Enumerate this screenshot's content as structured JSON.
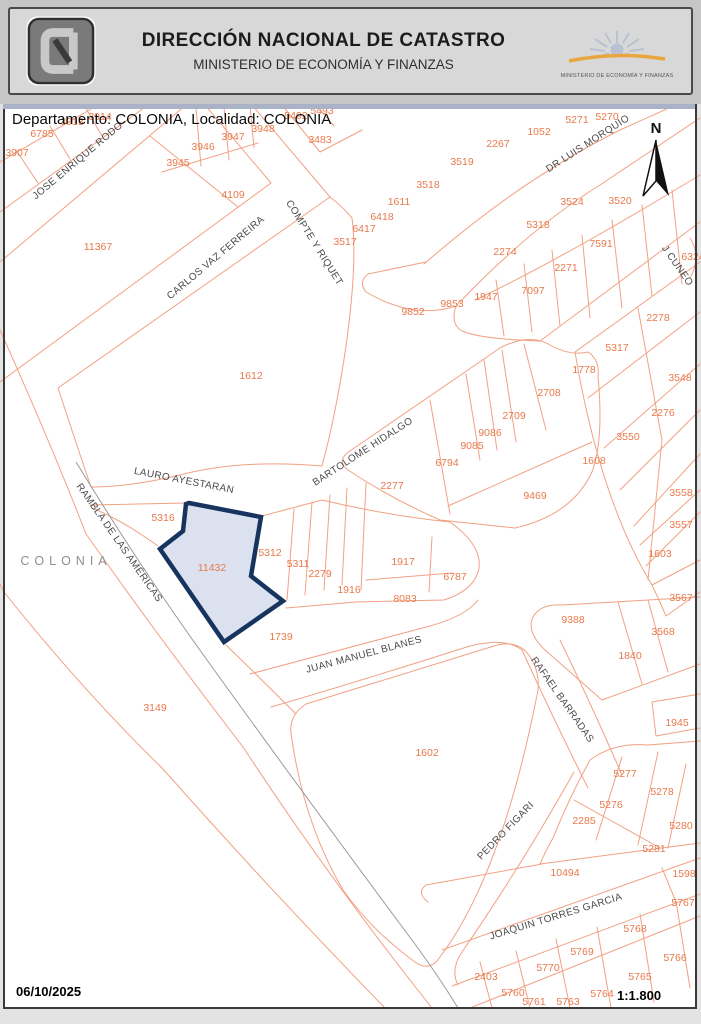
{
  "header": {
    "title": "DIRECCIÓN NACIONAL DE CATASTRO",
    "subtitle": "MINISTERIO DE ECONOMÍA Y FINANZAS",
    "right_logo_caption": "MINISTERIO DE ECONOMÍA Y FINANZAS",
    "left_logo_icon": "dnc-catastro-logo",
    "right_logo_icon": "mef-sun-logo"
  },
  "map": {
    "caption": "Departamento: COLONIA, Localidad: COLONIA",
    "locality_label": "COLONIA",
    "north_label": "N",
    "date": "06/10/2025",
    "scale": "1:1.800",
    "colors": {
      "parcel_line": "#f2a183",
      "parcel_text": "#e8794b",
      "street_text": "#4a4a4a",
      "road_centerline": "#9a9a9a",
      "highlight_stroke": "#17345f",
      "highlight_fill": "#dce1ef"
    },
    "highlighted_parcel": {
      "number": "11432",
      "x": 212,
      "y": 568
    },
    "parcel_labels": [
      {
        "number": "3914",
        "x": 100,
        "y": 117
      },
      {
        "number": "3913",
        "x": 72,
        "y": 122
      },
      {
        "number": "6785",
        "x": 42,
        "y": 134
      },
      {
        "number": "3907",
        "x": 17,
        "y": 153
      },
      {
        "number": "3946",
        "x": 203,
        "y": 147
      },
      {
        "number": "3947",
        "x": 233,
        "y": 137
      },
      {
        "number": "3948",
        "x": 263,
        "y": 129
      },
      {
        "number": "3945",
        "x": 178,
        "y": 163
      },
      {
        "number": "5492",
        "x": 296,
        "y": 116
      },
      {
        "number": "5493",
        "x": 322,
        "y": 111
      },
      {
        "number": "3483",
        "x": 320,
        "y": 140
      },
      {
        "number": "4109",
        "x": 233,
        "y": 195
      },
      {
        "number": "11367",
        "x": 98,
        "y": 247
      },
      {
        "number": "1612",
        "x": 251,
        "y": 376
      },
      {
        "number": "5271",
        "x": 577,
        "y": 120
      },
      {
        "number": "5270",
        "x": 607,
        "y": 117
      },
      {
        "number": "1052",
        "x": 539,
        "y": 132
      },
      {
        "number": "2267",
        "x": 498,
        "y": 144
      },
      {
        "number": "3519",
        "x": 462,
        "y": 162
      },
      {
        "number": "3518",
        "x": 428,
        "y": 185
      },
      {
        "number": "1611",
        "x": 399,
        "y": 202
      },
      {
        "number": "6418",
        "x": 382,
        "y": 217
      },
      {
        "number": "6417",
        "x": 364,
        "y": 229
      },
      {
        "number": "3517",
        "x": 345,
        "y": 242
      },
      {
        "number": "3524",
        "x": 572,
        "y": 202
      },
      {
        "number": "3520",
        "x": 620,
        "y": 201
      },
      {
        "number": "5318",
        "x": 538,
        "y": 225
      },
      {
        "number": "2274",
        "x": 505,
        "y": 252
      },
      {
        "number": "7591",
        "x": 601,
        "y": 244
      },
      {
        "number": "2271",
        "x": 566,
        "y": 268
      },
      {
        "number": "7097",
        "x": 533,
        "y": 291
      },
      {
        "number": "1947",
        "x": 486,
        "y": 297
      },
      {
        "number": "9853",
        "x": 452,
        "y": 304
      },
      {
        "number": "9852",
        "x": 413,
        "y": 312
      },
      {
        "number": "6324",
        "x": 693,
        "y": 257
      },
      {
        "number": "2278",
        "x": 658,
        "y": 318
      },
      {
        "number": "5317",
        "x": 617,
        "y": 348
      },
      {
        "number": "1778",
        "x": 584,
        "y": 370
      },
      {
        "number": "3548",
        "x": 680,
        "y": 378
      },
      {
        "number": "2276",
        "x": 663,
        "y": 413
      },
      {
        "number": "3550",
        "x": 628,
        "y": 437
      },
      {
        "number": "1608",
        "x": 594,
        "y": 461
      },
      {
        "number": "3558",
        "x": 681,
        "y": 493
      },
      {
        "number": "3557",
        "x": 681,
        "y": 525
      },
      {
        "number": "1603",
        "x": 660,
        "y": 554
      },
      {
        "number": "3567",
        "x": 681,
        "y": 598
      },
      {
        "number": "2708",
        "x": 549,
        "y": 393
      },
      {
        "number": "2709",
        "x": 514,
        "y": 416
      },
      {
        "number": "9086",
        "x": 490,
        "y": 433
      },
      {
        "number": "9085",
        "x": 472,
        "y": 446
      },
      {
        "number": "6794",
        "x": 447,
        "y": 463
      },
      {
        "number": "2277",
        "x": 392,
        "y": 486
      },
      {
        "number": "9469",
        "x": 535,
        "y": 496
      },
      {
        "number": "5316",
        "x": 163,
        "y": 518
      },
      {
        "number": "11432",
        "x": 212,
        "y": 568
      },
      {
        "number": "5312",
        "x": 270,
        "y": 553
      },
      {
        "number": "5311",
        "x": 298,
        "y": 564
      },
      {
        "number": "2279",
        "x": 320,
        "y": 574
      },
      {
        "number": "1916",
        "x": 349,
        "y": 590
      },
      {
        "number": "1917",
        "x": 403,
        "y": 562
      },
      {
        "number": "8083",
        "x": 405,
        "y": 599
      },
      {
        "number": "6787",
        "x": 455,
        "y": 577
      },
      {
        "number": "1739",
        "x": 281,
        "y": 637
      },
      {
        "number": "3149",
        "x": 155,
        "y": 708
      },
      {
        "number": "1602",
        "x": 427,
        "y": 753
      },
      {
        "number": "9388",
        "x": 573,
        "y": 620
      },
      {
        "number": "3568",
        "x": 663,
        "y": 632
      },
      {
        "number": "1840",
        "x": 630,
        "y": 656
      },
      {
        "number": "1945",
        "x": 677,
        "y": 723
      },
      {
        "number": "5277",
        "x": 625,
        "y": 774
      },
      {
        "number": "5278",
        "x": 662,
        "y": 792
      },
      {
        "number": "5276",
        "x": 611,
        "y": 805
      },
      {
        "number": "2285",
        "x": 584,
        "y": 821
      },
      {
        "number": "5280",
        "x": 681,
        "y": 826
      },
      {
        "number": "5281",
        "x": 654,
        "y": 849
      },
      {
        "number": "10494",
        "x": 565,
        "y": 873
      },
      {
        "number": "1598",
        "x": 684,
        "y": 874
      },
      {
        "number": "5767",
        "x": 683,
        "y": 903
      },
      {
        "number": "5768",
        "x": 635,
        "y": 929
      },
      {
        "number": "5769",
        "x": 582,
        "y": 952
      },
      {
        "number": "5766",
        "x": 675,
        "y": 958
      },
      {
        "number": "5770",
        "x": 548,
        "y": 968
      },
      {
        "number": "2403",
        "x": 486,
        "y": 977
      },
      {
        "number": "5765",
        "x": 640,
        "y": 977
      },
      {
        "number": "5760",
        "x": 513,
        "y": 993
      },
      {
        "number": "5764",
        "x": 602,
        "y": 994
      },
      {
        "number": "5761",
        "x": 534,
        "y": 1002
      },
      {
        "number": "5763",
        "x": 568,
        "y": 1002
      }
    ],
    "street_labels": [
      {
        "name": "JOSE ENRIQUE RODO",
        "x": 78,
        "y": 161,
        "angle": -40
      },
      {
        "name": "CARLOS VAZ FERREIRA",
        "x": 216,
        "y": 258,
        "angle": -40
      },
      {
        "name": "COMPTE Y RIQUET",
        "x": 314,
        "y": 243,
        "angle": 58
      },
      {
        "name": "DR LUIS MORQUIO",
        "x": 588,
        "y": 144,
        "angle": -33
      },
      {
        "name": "J CUNEO",
        "x": 677,
        "y": 266,
        "angle": 55
      },
      {
        "name": "BARTOLOME HIDALGO",
        "x": 363,
        "y": 452,
        "angle": -33
      },
      {
        "name": "LAURO AYESTARAN",
        "x": 184,
        "y": 481,
        "angle": 11
      },
      {
        "name": "RAMBLA DE LAS AMÉRICAS",
        "x": 119,
        "y": 543,
        "angle": 55
      },
      {
        "name": "JUAN MANUEL BLANES",
        "x": 364,
        "y": 655,
        "angle": -15
      },
      {
        "name": "RAFAEL BARRADAS",
        "x": 562,
        "y": 700,
        "angle": 55
      },
      {
        "name": "PEDRO FIGARI",
        "x": 506,
        "y": 831,
        "angle": -46
      },
      {
        "name": "JOAQUIN TORRES GARCIA",
        "x": 556,
        "y": 917,
        "angle": -17
      }
    ]
  }
}
